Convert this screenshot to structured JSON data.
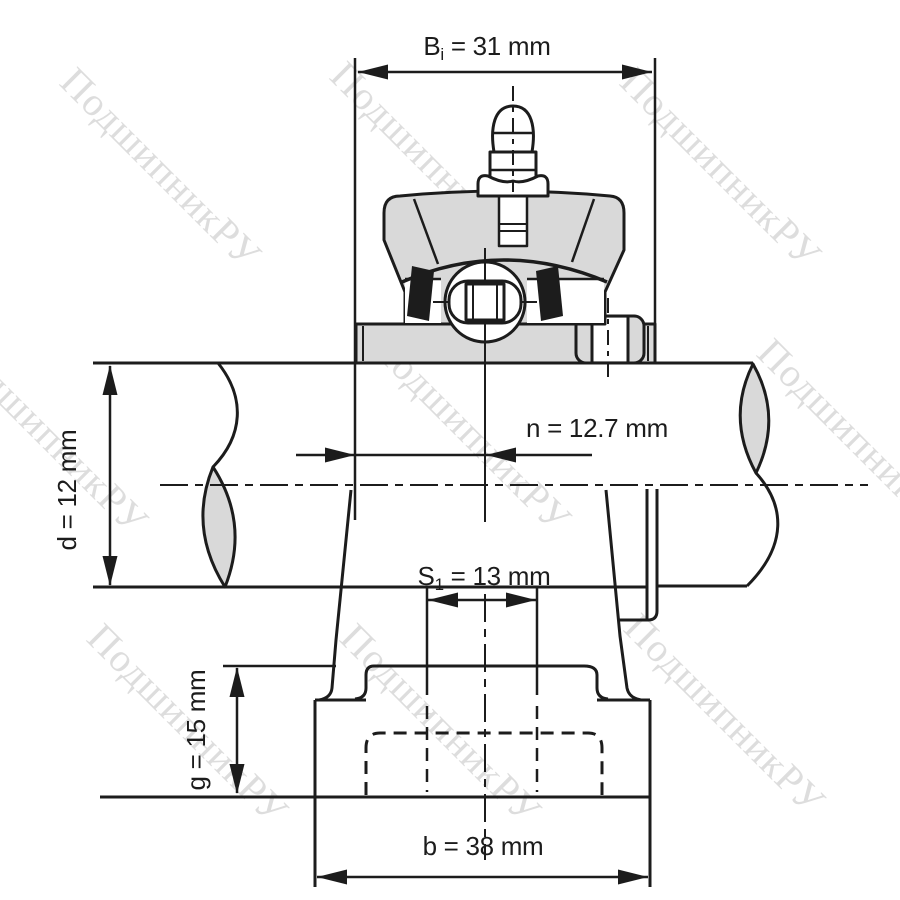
{
  "drawing": {
    "colors": {
      "background": "#ffffff",
      "line": "#1c1c1c",
      "fill_gray": "#d9d9d9",
      "watermark": "#c8c8c8"
    },
    "dimensions": {
      "Bi": {
        "symbol": "B",
        "subscript": "i",
        "rest": " = 31 mm"
      },
      "n": {
        "label": "n = 12.7 mm"
      },
      "d": {
        "label": "d = 12 mm"
      },
      "S1": {
        "symbol": "S",
        "subscript": "1",
        "rest": " = 13 mm"
      },
      "g": {
        "label": "g = 15 mm"
      },
      "b": {
        "label": "b = 38 mm"
      }
    },
    "watermark": {
      "text": "ПодшипникРУ"
    }
  }
}
